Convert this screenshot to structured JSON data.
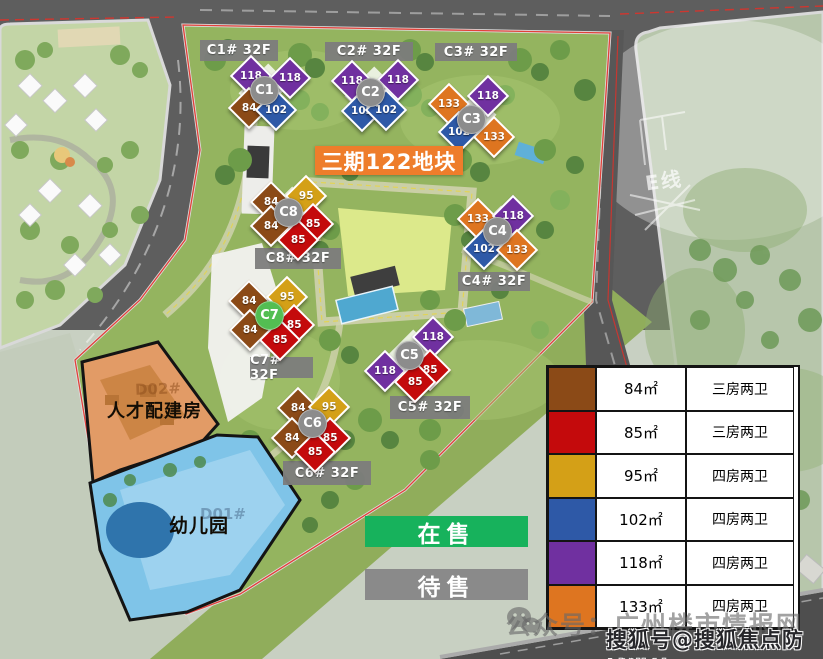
{
  "title": {
    "text": "三期122地块",
    "bg": "#EE7D2B"
  },
  "status": {
    "on_sale": "在售",
    "on_sale_bg": "#17B25C",
    "pending": "待售",
    "pending_bg": "#8A8A8A"
  },
  "plot_labels": {
    "talent_housing": "人才配建房",
    "talent_sub": "D02#",
    "kindergarten": "幼儿园",
    "kindergarten_sub": "D01#",
    "e_line": "E线"
  },
  "unit_colors": {
    "u84": "#8B4A17",
    "u85": "#C40A0C",
    "u95": "#D4A017",
    "u102": "#2E59A7",
    "u118": "#7030A0",
    "u133": "#DE7520"
  },
  "circle_colors": {
    "default": "#8C8C8C",
    "active": "#53BE52"
  },
  "buildings": [
    {
      "id": "C1",
      "label": "C1# 32F",
      "units": [
        {
          "v": "118",
          "t": "u118"
        },
        {
          "v": "118",
          "t": "u118"
        },
        {
          "v": "84",
          "t": "u84"
        },
        {
          "v": "102",
          "t": "u102"
        }
      ]
    },
    {
      "id": "C2",
      "label": "C2# 32F",
      "units": [
        {
          "v": "118",
          "t": "u118"
        },
        {
          "v": "118",
          "t": "u118"
        },
        {
          "v": "102",
          "t": "u102"
        },
        {
          "v": "102",
          "t": "u102"
        }
      ]
    },
    {
      "id": "C3",
      "label": "C3# 32F",
      "units": [
        {
          "v": "133",
          "t": "u133"
        },
        {
          "v": "118",
          "t": "u118"
        },
        {
          "v": "102",
          "t": "u102"
        },
        {
          "v": "133",
          "t": "u133"
        }
      ]
    },
    {
      "id": "C4",
      "label": "C4# 32F",
      "units": [
        {
          "v": "133",
          "t": "u133"
        },
        {
          "v": "118",
          "t": "u118"
        },
        {
          "v": "102",
          "t": "u102"
        },
        {
          "v": "133",
          "t": "u133"
        }
      ]
    },
    {
      "id": "C5",
      "label": "C5# 32F",
      "units": [
        {
          "v": "118",
          "t": "u118"
        },
        {
          "v": "118",
          "t": "u118"
        },
        {
          "v": "85",
          "t": "u85"
        },
        {
          "v": "85",
          "t": "u85"
        }
      ]
    },
    {
      "id": "C6",
      "label": "C6# 32F",
      "units": [
        {
          "v": "84",
          "t": "u84"
        },
        {
          "v": "95",
          "t": "u95"
        },
        {
          "v": "84",
          "t": "u84"
        },
        {
          "v": "85",
          "t": "u85"
        },
        {
          "v": "85",
          "t": "u85"
        }
      ]
    },
    {
      "id": "C7",
      "label": "C7# 32F",
      "units": [
        {
          "v": "84",
          "t": "u84"
        },
        {
          "v": "95",
          "t": "u95"
        },
        {
          "v": "84",
          "t": "u84"
        },
        {
          "v": "85",
          "t": "u85"
        },
        {
          "v": "85",
          "t": "u85"
        }
      ]
    },
    {
      "id": "C8",
      "label": "C8# 32F",
      "units": [
        {
          "v": "84",
          "t": "u84"
        },
        {
          "v": "95",
          "t": "u95"
        },
        {
          "v": "84",
          "t": "u84"
        },
        {
          "v": "85",
          "t": "u85"
        },
        {
          "v": "85",
          "t": "u85"
        }
      ]
    }
  ],
  "legend": {
    "rows": [
      {
        "color": "#8B4A17",
        "area": "84㎡",
        "type": "三房两卫"
      },
      {
        "color": "#C40A0C",
        "area": "85㎡",
        "type": "三房两卫"
      },
      {
        "color": "#D4A017",
        "area": "95㎡",
        "type": "四房两卫"
      },
      {
        "color": "#2E59A7",
        "area": "102㎡",
        "type": "四房两卫"
      },
      {
        "color": "#7030A0",
        "area": "118㎡",
        "type": "四房两卫"
      },
      {
        "color": "#DE7520",
        "area": "133㎡",
        "type": "四房两卫"
      }
    ]
  },
  "watermarks": {
    "wechat": "公众号：广州楼市情报网",
    "sohu": "搜狐号@搜狐焦点防城港站"
  }
}
